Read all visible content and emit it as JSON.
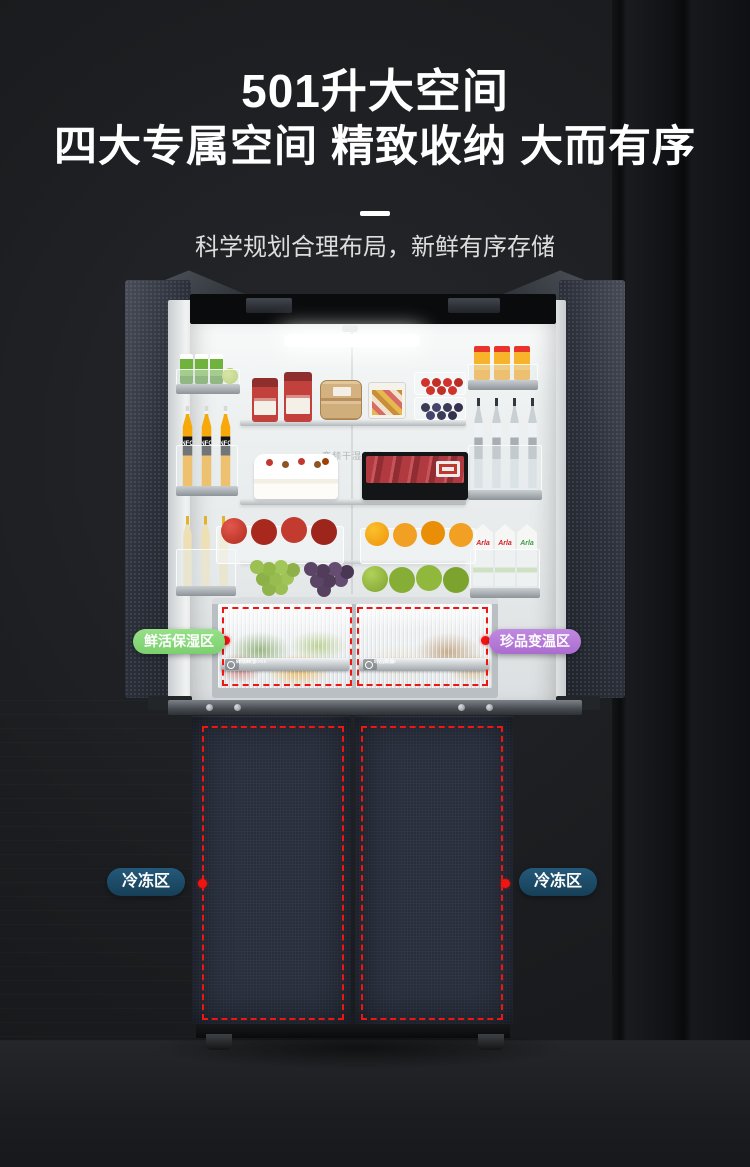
{
  "header": {
    "title_line1": "501升大空间",
    "title_line2": "四大专属空间 精致收纳 大而有序",
    "subtitle": "科学规划合理布局，新鲜有序存储"
  },
  "zone_labels": {
    "fresh": "鲜活保湿区",
    "variable_temp": "珍品变温区",
    "freezer_left": "冷冻区",
    "freezer_right": "冷冻区"
  },
  "drawer_tags": {
    "left_cn": "鲜活保湿",
    "left_en": "MOIST ZONE",
    "right_cn": "珍品变温",
    "right_en": "MY ZONE"
  },
  "interior": {
    "back_wall_print": "变频干湿分储",
    "juice_label": "NFC",
    "milk_brand": "Arla"
  },
  "colors": {
    "fresh_zone": "#8bd97d",
    "variable_zone": "#b77bd9",
    "freezer_zone": "#1d4b66",
    "annotation_red": "#f11511",
    "background": "#1b1d20"
  }
}
